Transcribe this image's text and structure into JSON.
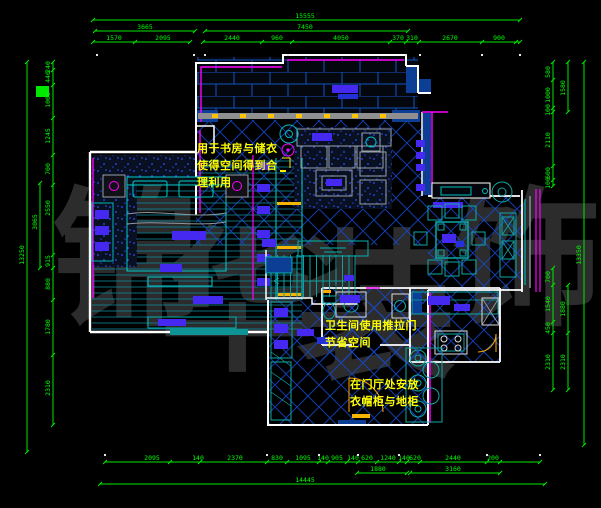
{
  "drawing": {
    "kind": "apartment-floor-plan",
    "colors": {
      "background": "#000000",
      "dimension_line": "#00e800",
      "dimension_text": "#00ff00",
      "wall": "#ffffff",
      "wall_fill_navy": "#0c3e96",
      "accent_magenta": "#ff00ff",
      "accent_cyan": "#00cdcd",
      "accent_teal": "#0fa6a6",
      "tile_line_blue": "#1546c8",
      "highlight_violet": "#4629f0",
      "accent_yellow": "#ffee00",
      "accent_orange": "#ffa800",
      "track_gray": "#8f8f8f"
    }
  },
  "annotations": {
    "study_note": "用于书房与储衣\n使得空间得到合\n理利用",
    "bathroom_note": "卫生间使用推拉门\n节省空间",
    "entry_note": "在门厅处安放\n衣帽柜与地柜"
  },
  "watermark": {
    "text": "锦华装饰",
    "chars": [
      "锦",
      "华",
      "装",
      "饰"
    ],
    "color": "#2c2c2c"
  },
  "dimensions": {
    "top": {
      "overall": "15555",
      "level2": [
        "3665",
        "7450"
      ],
      "segments": [
        "1570",
        "2095",
        "2440",
        "960",
        "4050",
        "370",
        "310",
        "2670",
        "900"
      ]
    },
    "bottom": {
      "overall": "14445",
      "level2": [
        "1880",
        "3160"
      ],
      "segments": [
        "2095",
        "140",
        "2370",
        "830",
        "1095",
        "140",
        "905",
        "140",
        "620",
        "1240",
        "140",
        "620",
        "2440",
        "200"
      ]
    },
    "left": {
      "overall": "13250",
      "level2": [
        "3065"
      ],
      "segments": [
        "240",
        "440",
        "1000",
        "1245",
        "700",
        "2550",
        "915",
        "880",
        "1780",
        "2310"
      ]
    },
    "right": {
      "overall": "13350",
      "level2": [
        "1580",
        "1880",
        "2310"
      ],
      "segments": [
        "580",
        "1000",
        "100",
        "2110",
        "600",
        "100",
        "700",
        "1540",
        "450",
        "2310"
      ]
    }
  },
  "dim_labels": {
    "top": [
      {
        "t": "15555",
        "x": 305,
        "y": 18
      },
      {
        "t": "3665",
        "x": 145,
        "y": 29
      },
      {
        "t": "7450",
        "x": 305,
        "y": 29
      },
      {
        "t": "1570",
        "x": 114,
        "y": 40
      },
      {
        "t": "2095",
        "x": 163,
        "y": 40
      },
      {
        "t": "2440",
        "x": 232,
        "y": 40
      },
      {
        "t": "960",
        "x": 277,
        "y": 40
      },
      {
        "t": "4050",
        "x": 341,
        "y": 40
      },
      {
        "t": "370",
        "x": 398,
        "y": 40
      },
      {
        "t": "310",
        "x": 412,
        "y": 40
      },
      {
        "t": "2670",
        "x": 450,
        "y": 40
      },
      {
        "t": "900",
        "x": 499,
        "y": 40
      }
    ],
    "bottom": [
      {
        "t": "2095",
        "x": 152,
        "y": 460
      },
      {
        "t": "140",
        "x": 198,
        "y": 460
      },
      {
        "t": "2370",
        "x": 235,
        "y": 460
      },
      {
        "t": "830",
        "x": 277,
        "y": 460
      },
      {
        "t": "1095",
        "x": 303,
        "y": 460
      },
      {
        "t": "140",
        "x": 323,
        "y": 460
      },
      {
        "t": "905",
        "x": 337,
        "y": 460
      },
      {
        "t": "140",
        "x": 353,
        "y": 460
      },
      {
        "t": "620",
        "x": 367,
        "y": 460
      },
      {
        "t": "1240",
        "x": 388,
        "y": 460
      },
      {
        "t": "140",
        "x": 404,
        "y": 460
      },
      {
        "t": "620",
        "x": 415,
        "y": 460
      },
      {
        "t": "2440",
        "x": 453,
        "y": 460
      },
      {
        "t": "200",
        "x": 493,
        "y": 460
      },
      {
        "t": "1880",
        "x": 378,
        "y": 471
      },
      {
        "t": "3160",
        "x": 453,
        "y": 471
      },
      {
        "t": "14445",
        "x": 305,
        "y": 482
      }
    ],
    "left": [
      {
        "t": "240",
        "x": 50,
        "y": 67,
        "r": -90
      },
      {
        "t": "440",
        "x": 50,
        "y": 77,
        "r": -90
      },
      {
        "t": "1000",
        "x": 50,
        "y": 100,
        "r": -90
      },
      {
        "t": "1245",
        "x": 50,
        "y": 136,
        "r": -90
      },
      {
        "t": "700",
        "x": 50,
        "y": 169,
        "r": -90
      },
      {
        "t": "2550",
        "x": 50,
        "y": 208,
        "r": -90
      },
      {
        "t": "915",
        "x": 50,
        "y": 261,
        "r": -90
      },
      {
        "t": "880",
        "x": 50,
        "y": 284,
        "r": -90
      },
      {
        "t": "1780",
        "x": 50,
        "y": 327,
        "r": -90
      },
      {
        "t": "2310",
        "x": 50,
        "y": 388,
        "r": -90
      },
      {
        "t": "3065",
        "x": 37,
        "y": 222,
        "r": -90
      },
      {
        "t": "13250",
        "x": 24,
        "y": 255,
        "r": -90
      }
    ],
    "right": [
      {
        "t": "580",
        "x": 550,
        "y": 72,
        "r": -90
      },
      {
        "t": "1000",
        "x": 550,
        "y": 95,
        "r": -90
      },
      {
        "t": "100",
        "x": 550,
        "y": 110,
        "r": -90
      },
      {
        "t": "2110",
        "x": 550,
        "y": 140,
        "r": -90
      },
      {
        "t": "600",
        "x": 550,
        "y": 173,
        "r": -90
      },
      {
        "t": "100",
        "x": 550,
        "y": 183,
        "r": -90
      },
      {
        "t": "700",
        "x": 550,
        "y": 277,
        "r": -90
      },
      {
        "t": "1540",
        "x": 550,
        "y": 304,
        "r": -90
      },
      {
        "t": "450",
        "x": 550,
        "y": 328,
        "r": -90
      },
      {
        "t": "2310",
        "x": 550,
        "y": 362,
        "r": -90
      },
      {
        "t": "1580",
        "x": 565,
        "y": 88,
        "r": -90
      },
      {
        "t": "1880",
        "x": 565,
        "y": 309,
        "r": -90
      },
      {
        "t": "2310",
        "x": 565,
        "y": 362,
        "r": -90
      },
      {
        "t": "13350",
        "x": 581,
        "y": 255,
        "r": -90
      }
    ]
  }
}
